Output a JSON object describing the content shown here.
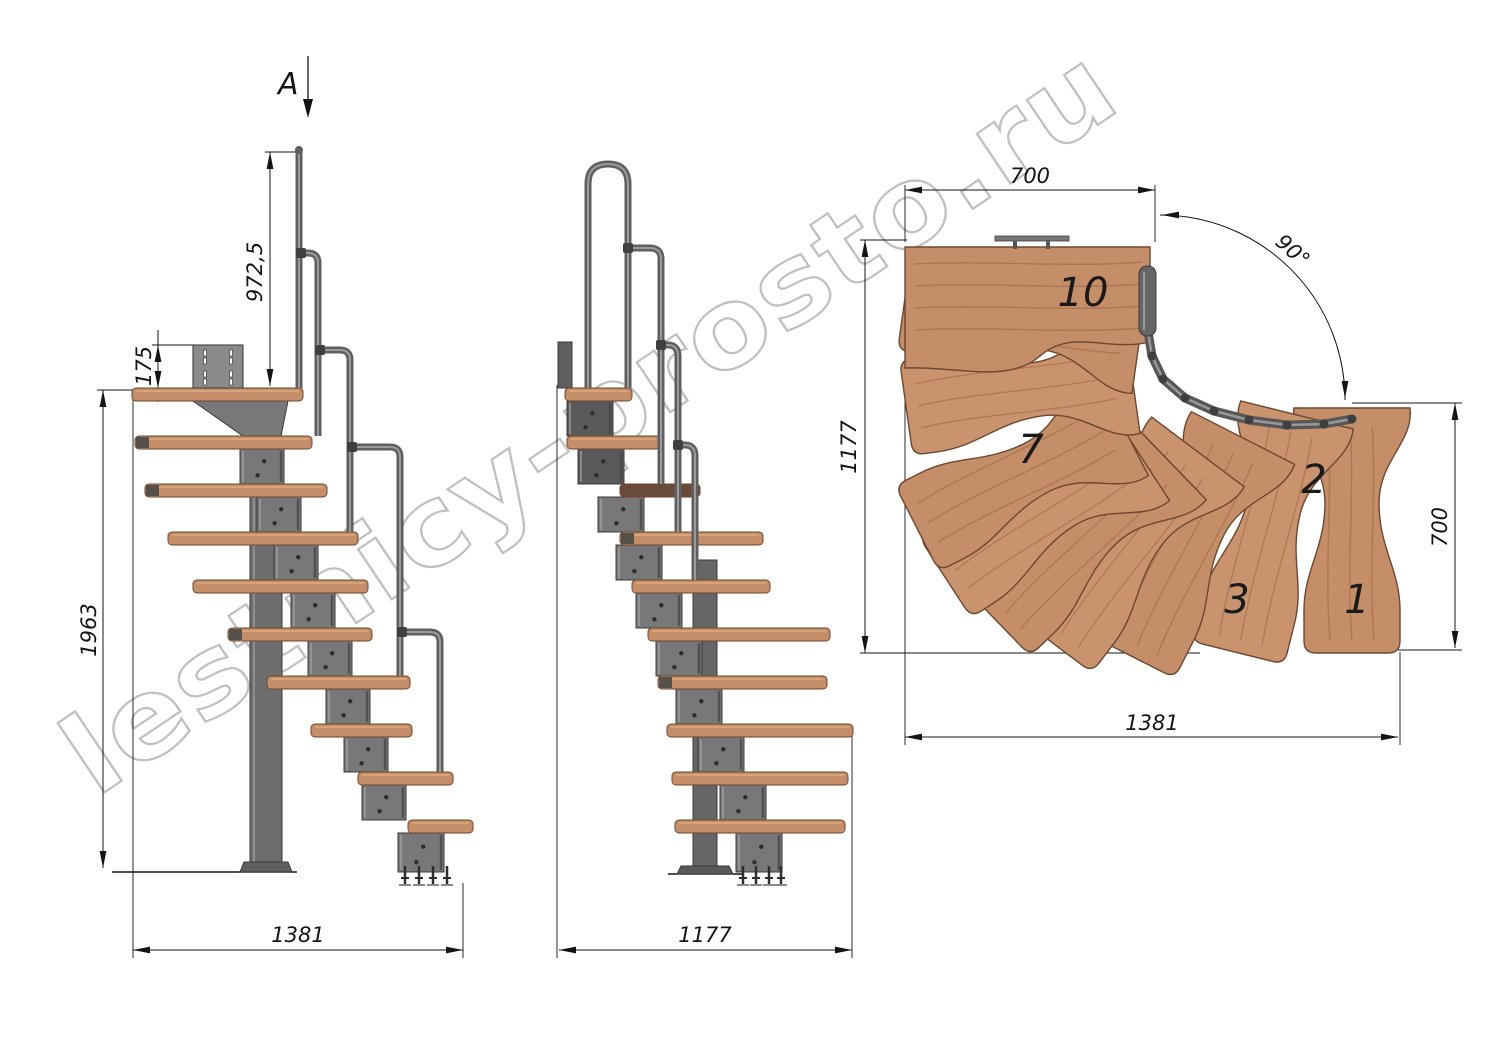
{
  "section_arrow": {
    "label": "A"
  },
  "dimensions": {
    "side_view": {
      "handrail_height": "972,5",
      "plate_height": "175",
      "total_height": "1963",
      "total_length": "1381"
    },
    "front_view": {
      "total_width": "1177"
    },
    "plan_view": {
      "top_run_width": "700",
      "left_depth": "1177",
      "right_run_depth": "700",
      "bottom_length": "1381",
      "turn_angle": "90°"
    }
  },
  "plan_tread_numbers": [
    "10",
    "7",
    "3",
    "2",
    "1"
  ],
  "watermark": "lestnicy-prosto.ru",
  "colors": {
    "wood": "#c48e68",
    "wood_light": "#d8a87e",
    "wood_edge": "#6d4730",
    "wood_dark": "#6a4a38",
    "metal": "#787878",
    "metal_dark": "#5c5c5c",
    "metal_stroke": "#3a3a3a",
    "rail": "#5f5f5f",
    "rail_light": "#a2a2a2",
    "line": "#141414",
    "watermark_gray": "#949494"
  }
}
